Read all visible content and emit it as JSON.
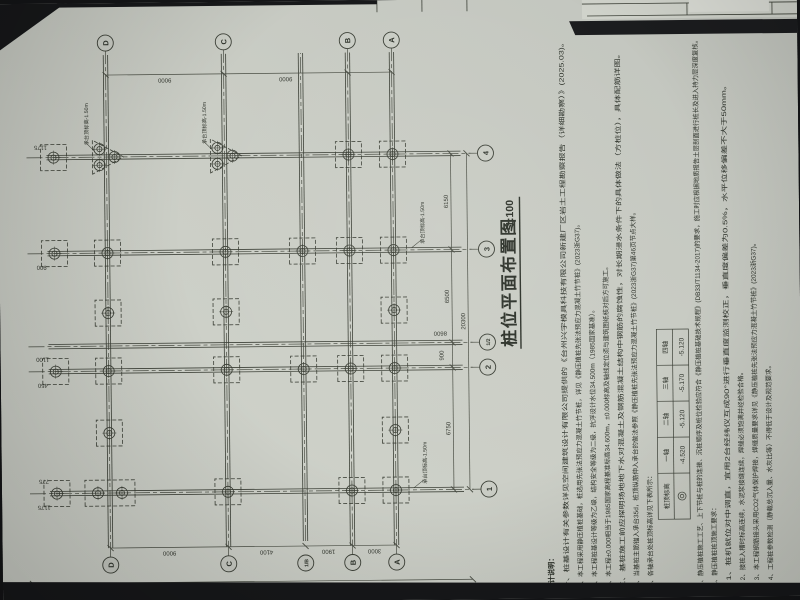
{
  "surface": {
    "paper_color": "#cacdc5",
    "paper_color_light": "#d2d5cd",
    "surround_color": "#17181a",
    "line_color": "#3c4037"
  },
  "title": {
    "text": "桩位平面布置图",
    "scale": "1:100"
  },
  "axes": {
    "numbers": [
      {
        "label": "1"
      },
      {
        "label": "2"
      },
      {
        "label": "1/2"
      },
      {
        "label": "3"
      },
      {
        "label": "4"
      }
    ],
    "letters": [
      {
        "label": "D"
      },
      {
        "label": "C"
      },
      {
        "label": "1/B"
      },
      {
        "label": "B"
      },
      {
        "label": "A"
      }
    ]
  },
  "dims": {
    "bottom_segments": [
      "6750",
      "900",
      "6500",
      "6150"
    ],
    "bottom_total": "20300",
    "extra_vertical": "8600",
    "left_segments": [
      "9000",
      "4100",
      "1900",
      "3000"
    ],
    "left_total": "44800",
    "right_segments": [
      "9000",
      "9000"
    ],
    "cap_dims": [
      "1175",
      "775",
      "450",
      "1100",
      "900",
      "1175"
    ]
  },
  "annotations": {
    "cap_label": "承台顶标高-1.50m"
  },
  "notes": {
    "heading": "设计说明：",
    "items": [
      "一、桩基设计有关参数详见空间建筑设计有限公司提供的《台州兴宇模具科技有限公司新建厂区岩土工程勘察报告（详细勘察）》(2025.03)。",
      "二、本工程采用静压植桩基础，桩选用先张法预应力混凝土竹节桩，详见《静压植桩先张法预应力混凝土竹节桩》(2023浙G37)。",
      "三、本工程桩基设计等级为乙级，结构安全等级为二级，抗浮设计水位34.500m（1985国家基准）。",
      "四、本工程±0.000相当于1985国家高程基准标高34.600m，±0.000标高及轴线定位须与建筑图纸核对后方可施工。",
      "五、基桩施工前应探明场地地下水对混凝土及钢筋混凝土结构中钢筋的腐蚀性，对长期浸水条件下的具体做法（方桩位），具体配筋详图。",
      "六、当基桩主筋锚入承台35d，桩顶纵筋伸入承台的做法参照《静压植桩先张法预应力混凝土竹节桩》(2023浙G37)第46页节点大样。",
      "七、各轴承台处桩顶标高详见下表所示：",
      "八、静压植桩施工工艺、上下节桩与桩的连接、沉桩顺序及桩位检验应符合《静压植桩基础技术规程》(DB33/T1134-2017)的要求，施工时应根据地质报告土层剖面进行桩长及进入持力层深度复核。",
      "九、静压植桩桩顶施工要求：",
      "1、桩机就位对中调直，宜用2台经纬仪互成90°进行垂直度监测校正，垂直度偏差为0.5%，水平位移偏差不大于50mm。",
      "2、接桩入槽时标高连续，水泥浆接缝连续，焊缝必须饱满并经检验合格。",
      "3、本工程钢筋接头采用CO2气体保护焊接，焊缝质量要求详见《静压植桩先张法预应力混凝土竹节桩》(2023浙G37)。",
      "4、工程桩参数检测（静载总沉入量、水灰比等）不得低于设计及规范要求。"
    ]
  },
  "pile_top_table": {
    "row_header": "桩顶标高",
    "columns": [
      "一轴",
      "二轴",
      "三轴",
      "四轴"
    ],
    "values": [
      "-4.520",
      "-5.120",
      "-5.170",
      "-5.120"
    ]
  }
}
